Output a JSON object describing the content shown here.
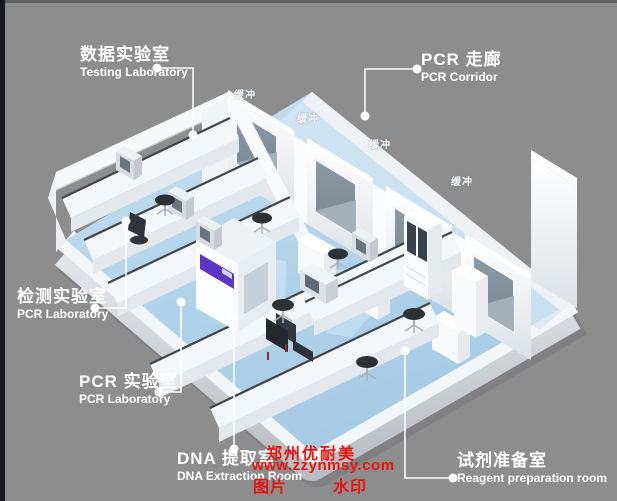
{
  "scene": {
    "background_color": "#8d8d8d",
    "floor_color": "#b1d3e9",
    "wall_color": "#f4f6f8",
    "window_color": "#8593a0",
    "accent_purple": "#5b35c8",
    "callout_color": "#ffffff",
    "watermark_letter": "W"
  },
  "labels": {
    "testing_lab": {
      "zh": "数据实验室",
      "en": "Testing Laboratory"
    },
    "pcr_corridor": {
      "zh": "PCR 走廊",
      "en": "PCR Corridor"
    },
    "detection_lab": {
      "zh": "检测实验室",
      "en": "PCR Laboratory"
    },
    "pcr_lab": {
      "zh": "PCR 实验室",
      "en": "PCR Laboratory"
    },
    "dna_extraction": {
      "zh": "DNA 提取室",
      "en": "DNA Extraction Room"
    },
    "reagent_prep": {
      "zh": "试剂准备室",
      "en": "Reagent preparation room"
    }
  },
  "buffer_labels": [
    {
      "text": "缓冲"
    },
    {
      "text": "缓冲"
    },
    {
      "text": "缓冲"
    },
    {
      "text": "缓冲"
    }
  ],
  "watermark": {
    "company": "郑州优耐美",
    "url": "www.zzynmsy.com",
    "left_word": "图片",
    "right_word": "水印",
    "color": "#e8130c"
  }
}
